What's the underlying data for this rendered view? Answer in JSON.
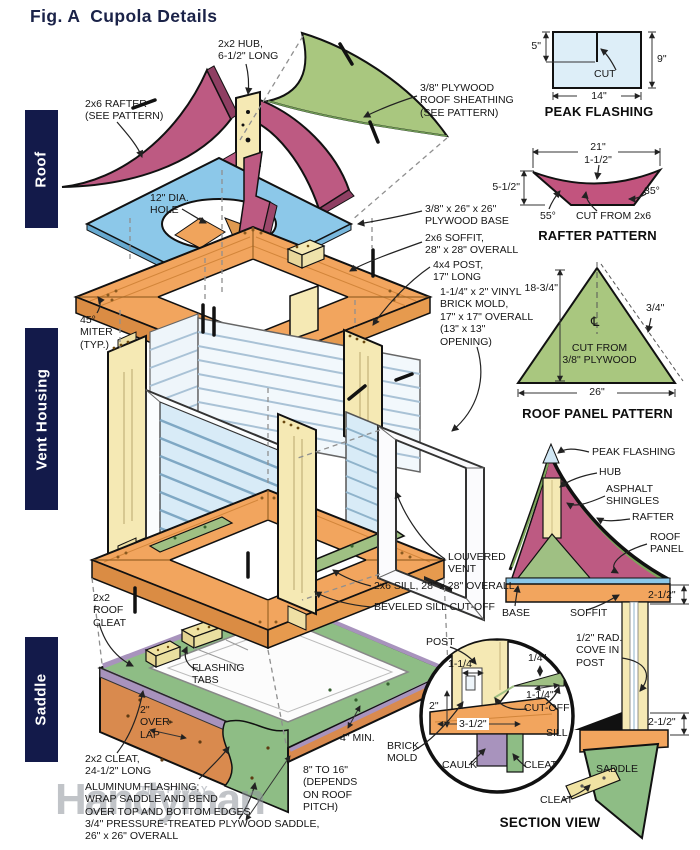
{
  "title": "Fig. A  Cupola Details",
  "sections": {
    "roof": "Roof",
    "vent_housing": "Vent Housing",
    "saddle": "Saddle"
  },
  "callouts": {
    "hub": "2x2 HUB,\n6-1/2\" LONG",
    "rafter": "2x6 RAFTER\n(SEE PATTERN)",
    "sheathing": "3/8\" PLYWOOD\nROOF SHEATHING\n(SEE PATTERN)",
    "hole": "12\" DIA.\nHOLE",
    "plywood_base": "3/8\" x 26\" x 26\"\nPLYWOOD BASE",
    "soffit": "2x6 SOFFIT,\n28\" x 28\" OVERALL",
    "post": "4x4 POST,\n17\" LONG",
    "brick_mold": "1-1/4\" x 2\" VINYL\nBRICK MOLD,\n17\" x 17\" OVERALL\n(13\" x 13\"\nOPENING)",
    "miter": "45°\nMITER\n(TYP.)",
    "louvered_vent": "LOUVERED\nVENT",
    "sill": "2x6 SILL, 28\" x 28\" OVERALL",
    "beveled_cutoff": "BEVELED SILL CUT-OFF",
    "roof_cleat": "2x2\nROOF\nCLEAT",
    "flashing_tabs": "FLASHING\nTABS",
    "overlap": "2\"\nOVER-\nLAP",
    "cleat": "2x2 CLEAT,\n24-1/2\" LONG",
    "aluminum": "ALUMINUM FLASHING;\nWRAP SADDLE AND BEND\nOVER TOP AND BOTTOM EDGES",
    "plywood_saddle": "3/4\" PRESSURE-TREATED PLYWOOD SADDLE,\n26\" x 26\" OVERALL",
    "min_4": "4\" MIN.",
    "pitch_range": "8\" TO 16\"\n(DEPENDS\nON ROOF\nPITCH)"
  },
  "panels": {
    "peak_flashing": {
      "title": "PEAK FLASHING",
      "dim_left": "5\"",
      "dim_right": "9\"",
      "dim_bottom": "14\"",
      "cut": "CUT"
    },
    "rafter_pattern": {
      "title": "RAFTER PATTERN",
      "dim_width": "21\"",
      "dim_center": "1-1/2\"",
      "dim_height": "5-1/2\"",
      "angle_left": "55°",
      "angle_right": "35°",
      "note": "CUT FROM 2x6"
    },
    "roof_panel_pattern": {
      "title": "ROOF PANEL PATTERN",
      "dim_height": "18-3/4\"",
      "dim_edge": "3/4\"",
      "centerline": "℄",
      "note": "CUT FROM\n3/8\" PLYWOOD",
      "dim_base": "26\""
    },
    "section_view": {
      "title": "SECTION VIEW",
      "peak_flashing": "PEAK FLASHING",
      "hub": "HUB",
      "shingles": "ASPHALT\nSHINGLES",
      "rafter": "RAFTER",
      "roof_panel": "ROOF\nPANEL",
      "base": "BASE",
      "soffit": "SOFFIT",
      "dim_upper": "2-1/2\"",
      "cove": "1/2\" RAD.\nCOVE IN\nPOST",
      "dim_lower": "2-1/2\"",
      "post": "POST",
      "dim_a": "1-1/4\"",
      "dim_b": "1/4\"",
      "dim_c": "1-1/4\"",
      "dim_d": "2\"",
      "cutoff": "CUT-OFF",
      "dim_e": "3-1/2\"",
      "sill": "SILL",
      "brick_mold": "BRICK\nMOLD",
      "caulk": "CAULK",
      "cleat_upper": "CLEAT",
      "saddle": "SADDLE",
      "cleat_lower": "CLEAT"
    }
  },
  "watermark": {
    "small": "THE FAMILY",
    "big": "Handyman"
  },
  "colors": {
    "navy": "#131a4a",
    "pink": "#bd5a82",
    "green": "#a9c77f",
    "blue": "#8cc8e9",
    "orange": "#f2a55e",
    "cream": "#f5e9b4",
    "saddle_green": "#8ebd85",
    "copper": "#d98a4e",
    "purple": "#a893bd",
    "flashing_blue": "#d8ebf7"
  }
}
